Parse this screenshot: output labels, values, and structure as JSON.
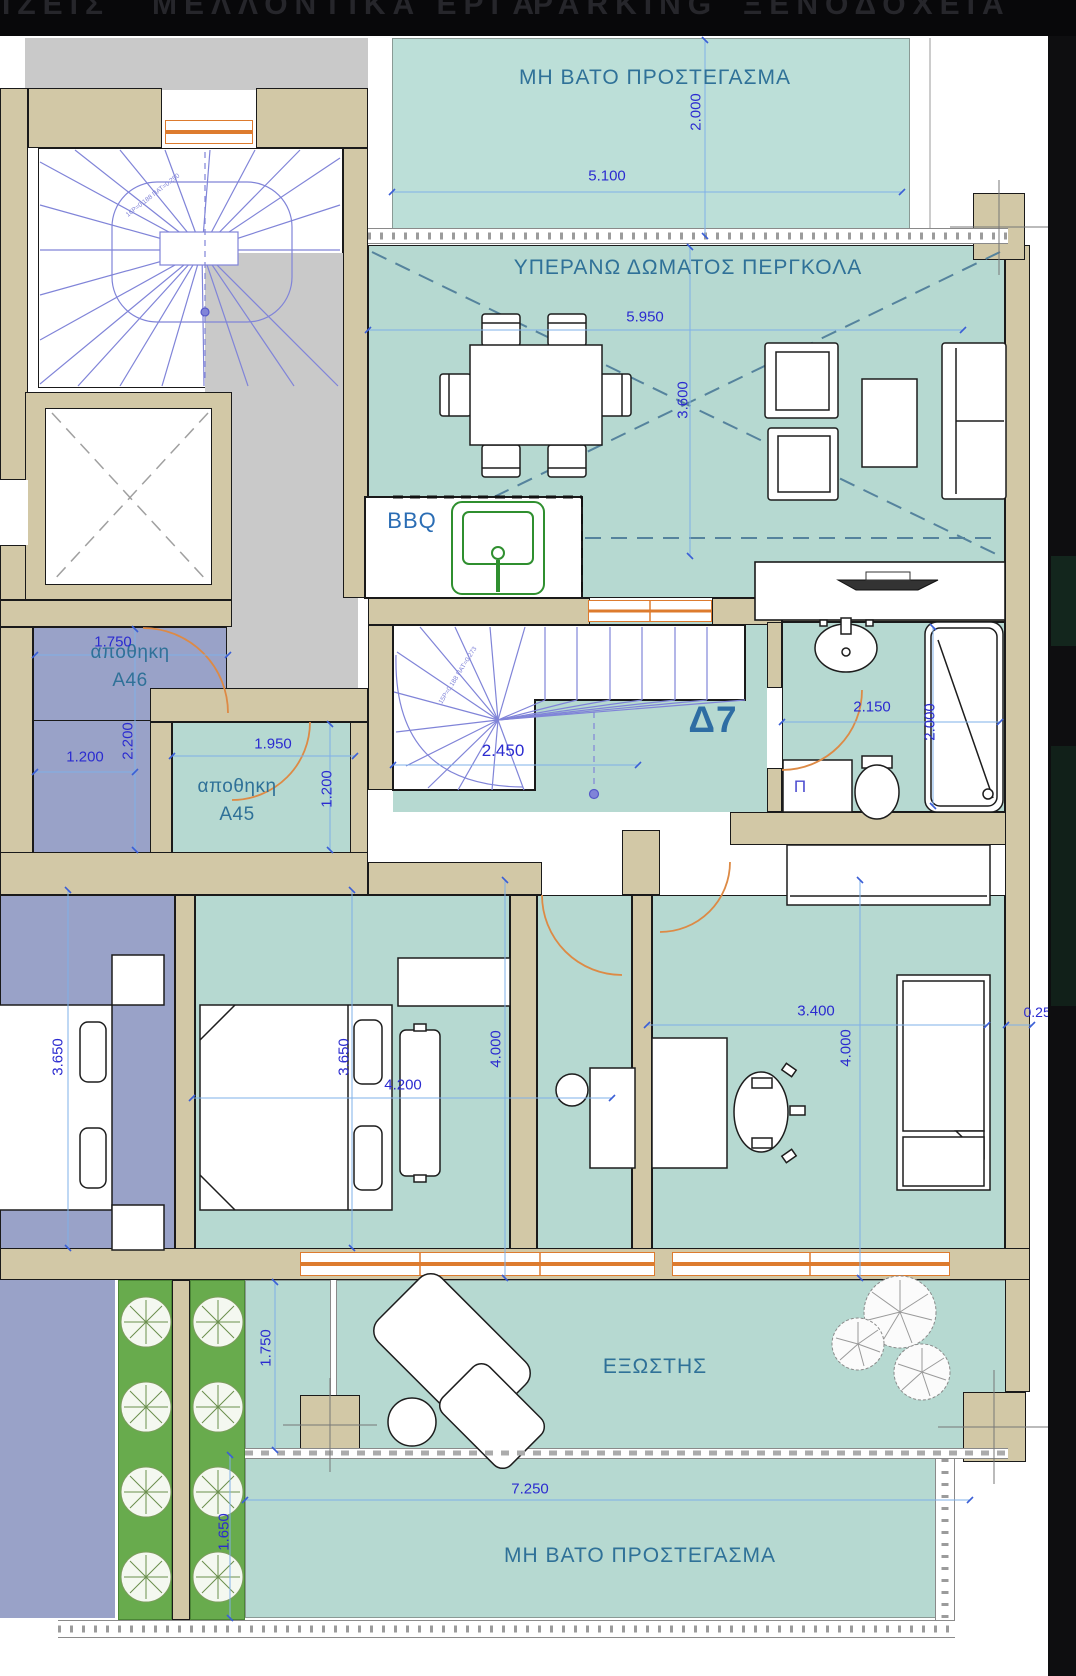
{
  "top_bar": {
    "items": [
      {
        "label": "ΙΖΕΙΣ"
      },
      {
        "label": "ΜΕΛΛΟΝΤΙΚΑ ΕΡΓΑ"
      },
      {
        "label": "PARKING"
      },
      {
        "label": "ΞΕΝΟΔΟΧΕΙΑ"
      }
    ]
  },
  "plan": {
    "unit_label": "Δ7",
    "rooms": {
      "canopy_top": "ΜΗ ΒΑΤΟ ΠΡΟΣΤΕΓΑΣΜΑ",
      "pergola": "ΥΠΕΡΑΝΩ ΔΩΜΑΤΟΣ ΠΕΡΓΚΟΛΑ",
      "bbq": "BBQ",
      "storage_word": "αποθηκη",
      "storage_a46": "Α46",
      "storage_a45": "Α45",
      "washer": "Π",
      "balcony": "ΕΞΩΣΤΗΣ",
      "canopy_bottom": "ΜΗ ΒΑΤΟ ΠΡΟΣΤΕΓΑΣΜΑ"
    },
    "dims": {
      "canopy_h": "2.000",
      "canopy_w": "5.100",
      "pergola_w": "5.950",
      "pergola_h": "3.600",
      "a46_door": "1.750",
      "a46_h": "2.200",
      "a46_w": "1.200",
      "a45_w": "1.950",
      "a45_h": "1.200",
      "stair_w": "2.450",
      "bath_w": "2.150",
      "bath_h": "2.000",
      "bed_left_h": "3.650",
      "bed1_h": "3.650",
      "bed1_w": "4.200",
      "bed1_h2": "4.000",
      "bed2_w": "3.400",
      "bed2_h": "4.000",
      "wall_t": "0.250",
      "balc_h": "1.750",
      "canopy_b_w": "7.250",
      "canopy_b_h": "1.650"
    },
    "notes": {
      "stair_top": "16Ρ=0.188 ΠΑΤ=0.250",
      "stair_inner": "15Ρ=0.188 ΠΑΤ=0.273"
    },
    "colors": {
      "wall": "#d2c8a6",
      "room_teal": "#b6d9d1",
      "canopy_teal": "#bcdfd8",
      "neighbor_purple": "#99a2c8",
      "planter_green": "#68ab4d",
      "landing_gray": "#c9c9c9",
      "dimension_blue": "#2b2bd0",
      "label_blue": "#2f7198",
      "door_orange": "#dd8a45",
      "stair_blue": "#8084d8"
    }
  }
}
